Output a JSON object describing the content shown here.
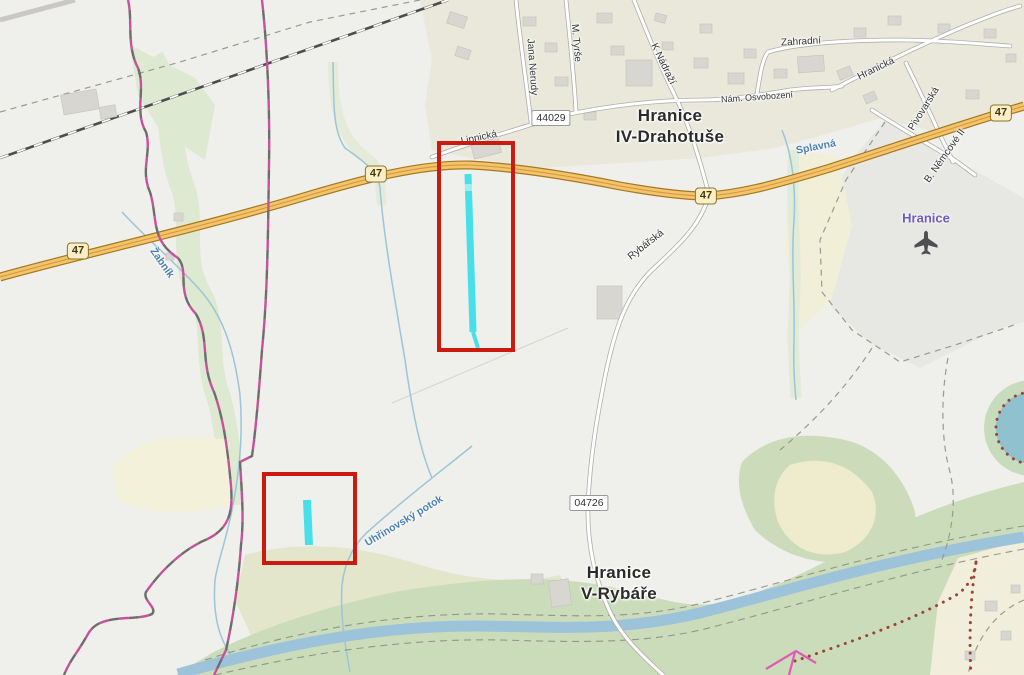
{
  "map": {
    "towns": {
      "drahotuse": {
        "line1": "Hranice",
        "line2": "IV-Drahotuše"
      },
      "rybare": {
        "line1": "Hranice",
        "line2": "V-Rybáře"
      }
    },
    "airport": {
      "label": "Hranice"
    },
    "streets": {
      "jana_nerudy": "Jana Nerudy",
      "m_tyrse": "M. Tyrše",
      "k_nadrazi": "K Nádraží",
      "zahradni": "Zahradní",
      "nam_osvobozeni": "Nám. Osvobození",
      "hranicka": "Hranická",
      "pivovarska": "Pivovarská",
      "b_nemcove": "B. Němcové II",
      "lipnicka": "Lipnická",
      "rybarska": "Rybářská"
    },
    "waterways": {
      "zabnik": "Žabník",
      "splavna": "Splavná",
      "uhrinovsky_potok": "Uhřinovský potok"
    },
    "shields": {
      "route_47": "47",
      "route_44029": "44029",
      "route_04726": "04726"
    },
    "annotations": {
      "rectangle_count": 2,
      "rectangle_color": "#cb1b10",
      "highlight_color": "#3fdfe8"
    },
    "colors": {
      "background": "#efefeb",
      "trunk_road_fill": "#f3c36d",
      "trunk_road_casing": "#a5791f",
      "water": "#9cc3da",
      "forest": "#cbdcba",
      "boundary_pink": "#c9509e",
      "water_label": "#4a80b5",
      "airport_label": "#6f5bbf"
    }
  }
}
